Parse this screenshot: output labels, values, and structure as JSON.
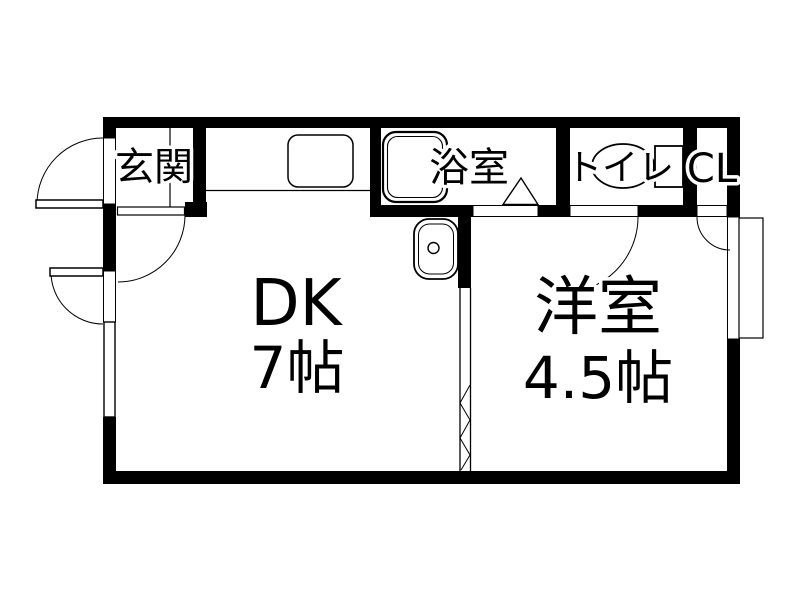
{
  "plan": {
    "type": "floorplan",
    "colors": {
      "wall": "#000000",
      "background": "#ffffff",
      "line": "#000000"
    },
    "rooms": {
      "entrance": {
        "label": "玄関"
      },
      "bathroom": {
        "label": "浴室"
      },
      "toilet": {
        "label": "トイレ"
      },
      "closet": {
        "label": "CL"
      },
      "dining_kitchen": {
        "label": "DK",
        "size": "7帖"
      },
      "western_room": {
        "label": "洋室",
        "size": "4.5帖"
      }
    },
    "fixtures": [
      "bathtub",
      "kitchen-sink",
      "kitchen-counter",
      "washbasin",
      "toilet-bowl",
      "accordion-door",
      "windows",
      "hinged-doors"
    ]
  }
}
